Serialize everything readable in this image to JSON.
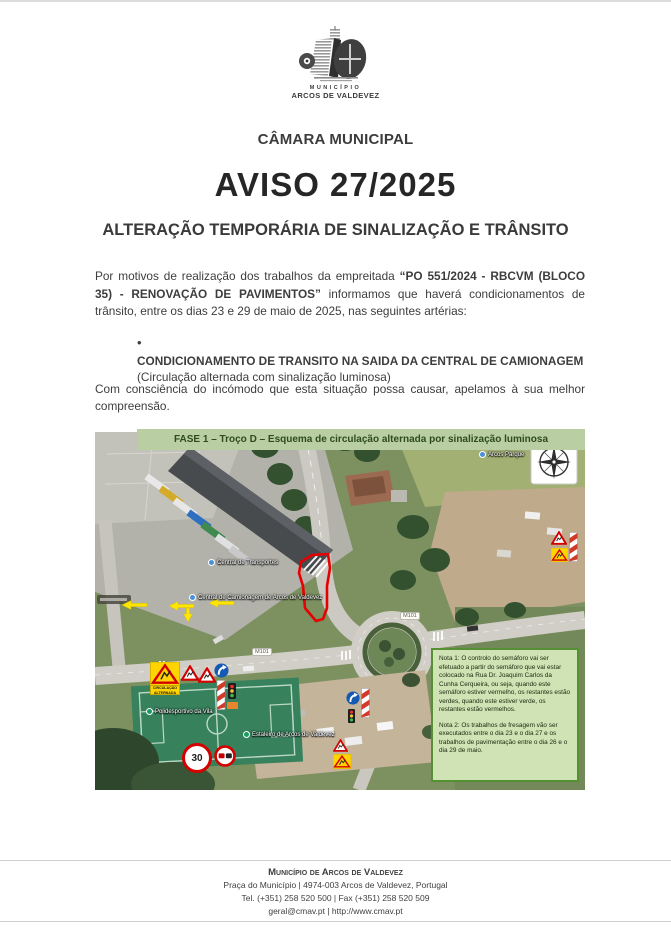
{
  "document": {
    "logo": {
      "seal_title": "MUNICÍPIO",
      "seal_subtitle": "ARCOS DE VALDEVEZ"
    },
    "org_title": "CÂMARA MUNICIPAL",
    "notice_title": "AVISO 27/2025",
    "notice_subtitle": "ALTERAÇÃO TEMPORÁRIA DE SINALIZAÇÃO E TRÂNSITO",
    "intro_pre": "Por motivos de realização dos trabalhos da empreitada ",
    "intro_bold": "“PO 551/2024 - RBCVM (BLOCO 35) - RENOVAÇÃO DE PAVIMENTOS”",
    "intro_post": " informamos que haverá condicionamentos de trânsito, entre os dias 23 e 29 de maio de 2025, nas seguintes artérias:",
    "bullet_glyph": "•",
    "bullet_bold": "CONDICIONAMENTO DE TRANSITO NA SAIDA DA CENTRAL DE CAMIONAGEM",
    "bullet_detail": "(Circulação alternada com sinalização luminosa)",
    "closing": "Com consciência do incómodo que esta situação possa causar, apelamos à sua melhor compreensão."
  },
  "map": {
    "banner": "FASE 1 – Troço D – Esquema de circulação alternada por sinalização luminosa",
    "note1": "Nota 1: O controlo do semáforo vai ser efetuado a partir do semáforo que vai estar colocado na Rua Dr. Joaquim Carlos da Cunha Cerqueira, ou seja, quando este semáforo estiver vermelho, os restantes estão verdes, quando este estiver verde, os restantes estão vermelhos.",
    "note2": "Nota 2: Os trabalhos de fresagem vão ser executados entre o dia 23 e o dia 27 e os trabalhos de pavimentação entre o dia 26 e o dia 29 de maio.",
    "labels": {
      "transportes": "Central de Transportes",
      "camionagem": "Central de Camionagem de Arcos de Valdevez",
      "polidesportivo": "Polidesportivo da Vila",
      "estaleiro": "Estaleiro de Arcos de Valdevez",
      "parque": "Arcos Parque"
    },
    "road_ref": "M101",
    "speed_limit": "30",
    "sign_caption": "CIRCULAÇÃO ALTERNADA"
  },
  "footer": {
    "name": "Município de Arcos de Valdevez",
    "address": "Praça do Município | 4974-003  Arcos de Valdevez, Portugal",
    "phones": "Tel. (+351) 258 520 500 | Fax (+351) 258 520 509",
    "web": "geral@cmav.pt | http://www.cmav.pt"
  },
  "colors": {
    "banner_bg": "#b9cfa3",
    "banner_text": "#2f4a1d",
    "note_bg": "#cfe3b4",
    "note_border": "#569035",
    "zone_outline": "#e60000",
    "arrow_yellow": "#ffe600",
    "sign_red": "#d40000"
  }
}
